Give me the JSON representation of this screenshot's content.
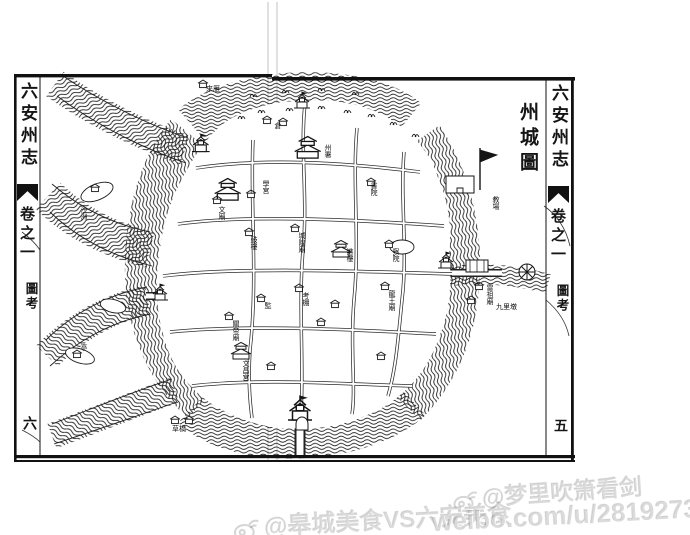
{
  "book": {
    "left_margin": {
      "title": "六安州志",
      "chapter": "卷之一",
      "section": "圖考",
      "page_number": "六"
    },
    "right_margin": {
      "title": "六安州志",
      "chapter": "卷之一",
      "section": "圖考",
      "page_number": "五"
    }
  },
  "map": {
    "title": "州城圖",
    "labels": [
      {
        "text": "倉"
      },
      {
        "text": "州署"
      },
      {
        "text": "學宮"
      },
      {
        "text": "文廟"
      },
      {
        "text": "書院"
      },
      {
        "text": "鼓樓"
      },
      {
        "text": "城隍廟"
      },
      {
        "text": "譙樓"
      },
      {
        "text": "察院"
      },
      {
        "text": "考棚"
      },
      {
        "text": "監"
      },
      {
        "text": "關帝廟"
      },
      {
        "text": "龍王廟"
      },
      {
        "text": "文昌宮"
      },
      {
        "text": "教場"
      },
      {
        "text": "雷祖廟"
      },
      {
        "text": "九里墩"
      },
      {
        "text": "沙洲"
      },
      {
        "text": "來雁"
      },
      {
        "text": "亭"
      },
      {
        "text": "草橋"
      }
    ]
  },
  "watermarks": {
    "right": {
      "handle": "@梦里吹箫看剑"
    },
    "bottom": {
      "handle": "@皋城美食VS六安美食",
      "url": "weibo.com/u/2819273092"
    }
  }
}
